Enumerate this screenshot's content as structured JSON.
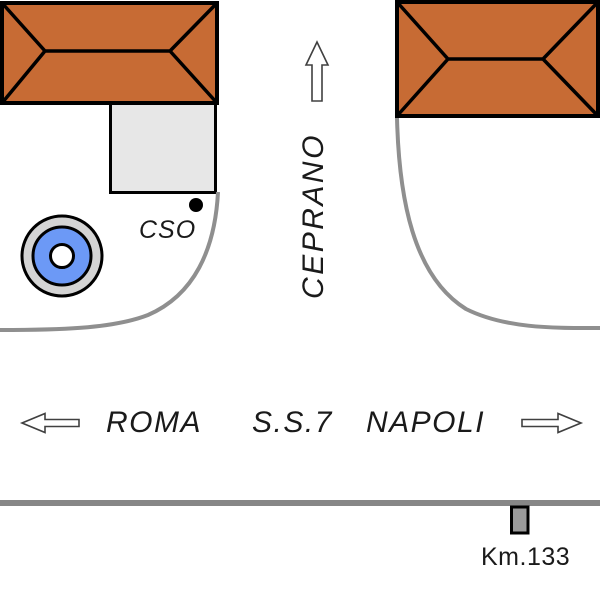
{
  "labels": {
    "direction_north": "CEPRANO",
    "building_marker": "CSO",
    "destination_west": "ROMA",
    "road_name": "S.S.7",
    "destination_east": "NAPOLI",
    "km_marker": "Km.133"
  },
  "colors": {
    "roof": "#C76B34",
    "annex": "#E7E7E7",
    "road": "#8F8F8F",
    "main_road": "#878787",
    "well_ring": "#D4D4D4",
    "well_blue": "#6C99F6",
    "km_post": "#9A9A9A"
  }
}
